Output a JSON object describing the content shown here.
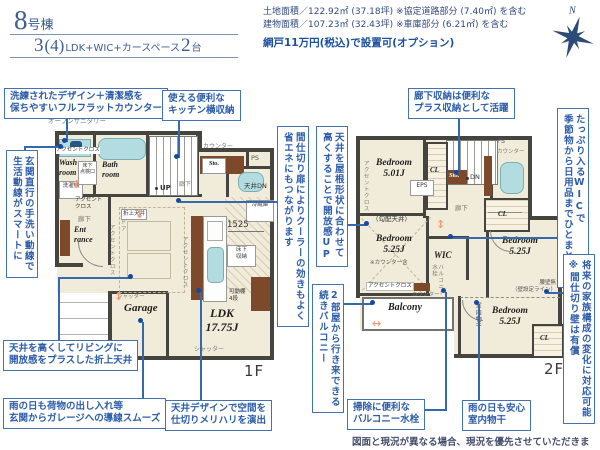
{
  "colors": {
    "accent_blue": "#2e5ea8",
    "header_navy": "#3d5c94",
    "wall_dark": "#45443f",
    "room_beige": "#f1ecda",
    "fixture_cyan": "#b2dce0",
    "wood_brown": "#7c4a2a",
    "arrow_orange": "#ef9c79"
  },
  "header": {
    "building_no": "8",
    "building_suffix": "号棟",
    "plan_num": "3",
    "plan_paren": "(4)",
    "plan_desc": "LDK+WIC+カースペース",
    "plan_cars": "2",
    "plan_cars_unit": "台"
  },
  "info": {
    "line1": "土地面積／122.92㎡ (37.18坪) ※協定道路部分 (7.40㎡) を含む",
    "line2": "建物面積／107.23㎡ (32.43坪) ※車庫部分 (6.21㎡) を含む",
    "line3": "網戸11万円(税込)で設置可(オプション)"
  },
  "compass": {
    "n": "N"
  },
  "callouts": [
    {
      "text": "洗練されたデザイン＋清潔感を\n保ちやすいフルフラットカウンター"
    },
    {
      "text": "使える便利な\nキッチン横収納"
    },
    {
      "text": "玄関直行の手洗い動線で\n生活動線がスマートに"
    },
    {
      "text": "廊下収納は便利な\nプラス収納として活躍"
    },
    {
      "text": "たっぷり入るWICで\n季節物から日用品までひとまとめに"
    },
    {
      "text": "天井を屋根形状に合わせて\n高くすることで開放感UP"
    },
    {
      "text": "間仕切り扉によりクーラーの効きもよく\n省エネにもつながります"
    },
    {
      "text": "天井を高くしてリビングに\n開放感をプラスした折上天井"
    },
    {
      "text": "雨の日も荷物の出し入れ等\n玄関からガレージへの導線スムーズ"
    },
    {
      "text": "天井デザインで空間を\n仕切りメリハリを演出"
    },
    {
      "text": "2部屋から行き来できる\n続きバルコニー"
    },
    {
      "text": "掃除に便利な\nバルコニー水栓"
    },
    {
      "text": "雨の日も安心\n室内物干"
    },
    {
      "text": "将来の家族構成の変化に対応可能\n※間仕切り壁は有償"
    }
  ],
  "f1": {
    "floor": "1F",
    "open_sanitary": "オープンサニタリー",
    "accent_wash": "アクセントクロス",
    "wash_room": "Wash\nroom",
    "underfloor_access": "床下\n点検口",
    "bath_room": "Bath\nroom",
    "washer": "洗濯機",
    "accent_hall": "アクセント\nクロス",
    "hall_a": "廊下",
    "entrance": "Ent\nrance",
    "high_door": "ハイドア",
    "accent_ent": "アクセントクロス",
    "counter": "カウンター",
    "sto": "Sto.",
    "ps": "PS",
    "up": "UP",
    "hall_b": "廊下",
    "ceiling_dn": "天井DN",
    "fridge": "冷蔵庫",
    "coffered": "折上天井",
    "dim_1525": "1525",
    "underfloor_sto": "床下\n収納",
    "accent_kitchen": "アクセントクロス",
    "popup_ceiling": "ポップアップ天井",
    "shelf": "可動棚\n4段",
    "ldk": "LDK\n17.75J",
    "shutter_a": "シャッター",
    "garage": "Garage",
    "shutter_b": "シャッター"
  },
  "f2": {
    "floor": "2F",
    "accent_bed1": "アクセントクロス",
    "bed1": "Bedroom\n5.01J",
    "cl": "CL",
    "eps": "EPS",
    "sto": "Sto.",
    "dn": "DN",
    "ps": "PS",
    "counter_a": "カウンター",
    "hall": "廊下",
    "sloped": "（勾配天井）",
    "bed2": "Bedroom\n5.25J",
    "bed2_note": "※カウンター含",
    "accent_bed2": "アクセントクロス",
    "wic": "WIC",
    "balcony_tap": "バルコニー\n水栓",
    "counter_b": "カウンター",
    "balcony": "Balcony",
    "low_wall": "腰壁無\n（壁設定ライン）",
    "indoor_drying": "室内物干",
    "bed3": "Bedroom\n5.25J",
    "bed4": "Bedroom\n5.25J",
    "cl2": "CL",
    "cl3": "CL"
  },
  "footer": {
    "disclaimer": "図面と現況が異なる場合、現況を優先させていただきます。"
  }
}
